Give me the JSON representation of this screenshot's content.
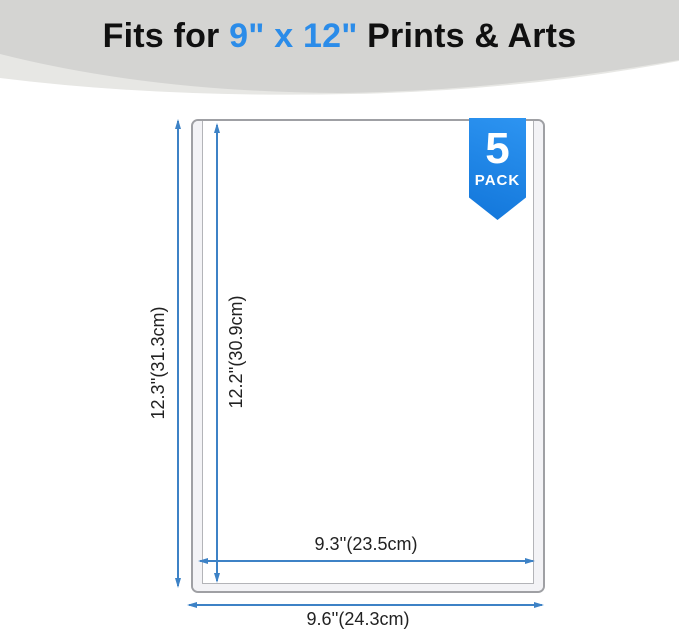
{
  "theme": {
    "accent_blue": "#2b8ce9",
    "ribbon_blue_top": "#2d94f1",
    "ribbon_blue_bottom": "#1276da",
    "dimension_blue": "#3d82c6",
    "header_gray": "#d4d4d2",
    "header_gray_light": "#e7e7e4",
    "frame_border": "#9fa0a4",
    "rail_fill": "#f3f3f6",
    "rail_edge": "#b3b4b8",
    "text_dark": "#101010"
  },
  "header": {
    "title_prefix": "Fits for ",
    "title_highlight": "9\" x 12\"",
    "title_suffix": " Prints & Arts"
  },
  "badge": {
    "count": "5",
    "label": "PACK"
  },
  "diagram": {
    "outer_height_label": "12.3''(31.3cm)",
    "inner_height_label": "12.2''(30.9cm)",
    "inner_width_label": "9.3''(23.5cm)",
    "outer_width_label": "9.6''(24.3cm)"
  }
}
